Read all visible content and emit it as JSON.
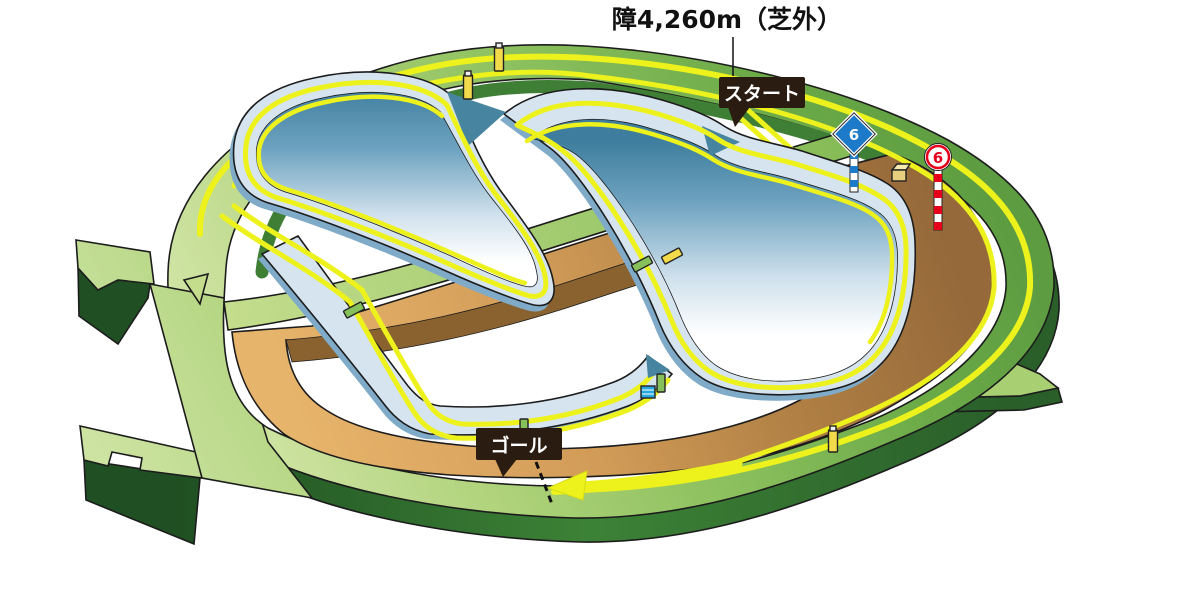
{
  "title": {
    "text": "障4,260m（芝外）"
  },
  "labels": {
    "start": "スタート",
    "goal": "ゴール"
  },
  "markers": {
    "blue_diamond": {
      "value": "6",
      "fill": "#1d7ac9",
      "pole_style": "blue-white-striped"
    },
    "red_circle": {
      "value": "6",
      "color": "#e60019",
      "pole_style": "red-white-striped"
    }
  },
  "colors": {
    "course_path_yellow": "#edf21c",
    "turf_green": "#a3cd70",
    "turf_dark_side": "#2f6b2f",
    "dirt_tan": "#cf9b55",
    "dirt_wall_brown": "#8a6230",
    "steeple_course_blue": "#d6e4f0",
    "steeple_inner_teal": "#4383a5",
    "label_bg": "#2a1c10",
    "label_text": "#ffffff"
  },
  "icons": {
    "hurdle_yellow": "#f2da4a",
    "hurdle_green": "#86c05a",
    "water_jump_blue": "#29a8e0"
  }
}
